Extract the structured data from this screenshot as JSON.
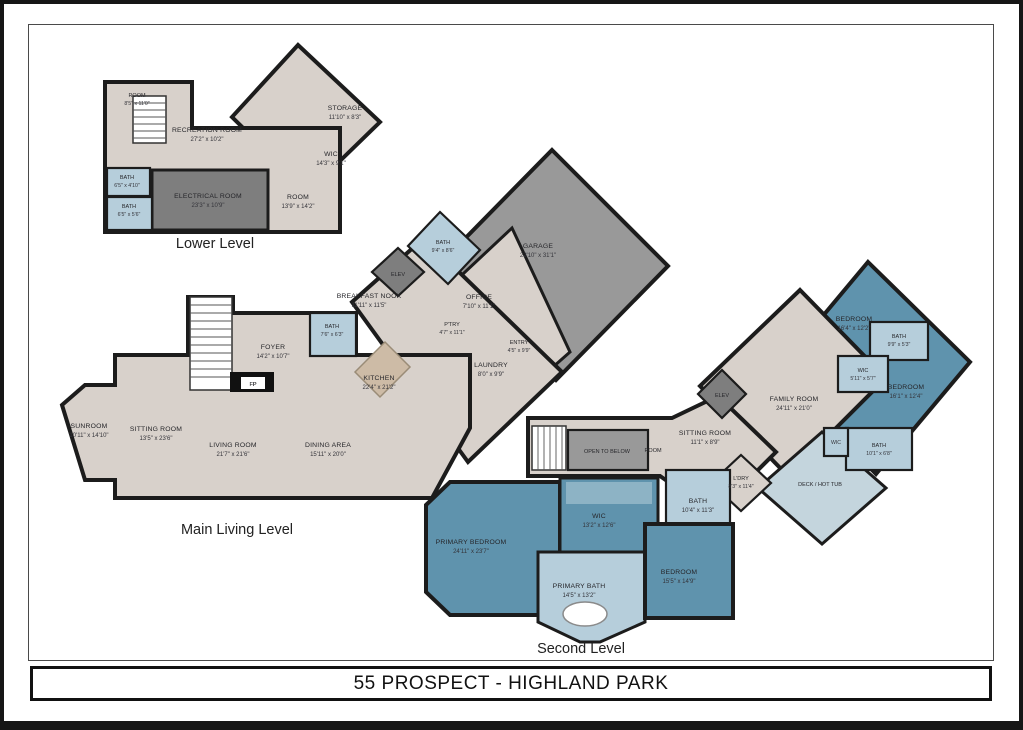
{
  "title": "55 PROSPECT - HIGHLAND PARK",
  "colors": {
    "floor_beige": "#d8d1cb",
    "bedroom_blue": "#5f93ad",
    "bath_blue": "#b6cedb",
    "deck_blue": "#c4d5dd",
    "garage_gray": "#999999",
    "utility_gray": "#7e7e7e",
    "wall": "#1c1c1c"
  },
  "levels": [
    {
      "name": "Lower Level",
      "rooms": [
        {
          "name": "ROOM",
          "dims": "8'5\" x 11'0\""
        },
        {
          "name": "RECREATION ROOM",
          "dims": "27'2\" x 10'2\""
        },
        {
          "name": "STORAGE",
          "dims": "11'10\" x 8'3\""
        },
        {
          "name": "WIC",
          "dims": "14'3\" x 9'1\""
        },
        {
          "name": "BATH",
          "dims": "6'5\" x 4'10\""
        },
        {
          "name": "BATH",
          "dims": "6'5\" x 5'6\""
        },
        {
          "name": "ELECTRICAL ROOM",
          "dims": "23'3\" x 10'9\""
        },
        {
          "name": "ROOM",
          "dims": "13'9\" x 14'2\""
        }
      ]
    },
    {
      "name": "Main Living Level",
      "rooms": [
        {
          "name": "GARAGE",
          "dims": "22'10\" x 31'1\""
        },
        {
          "name": "BATH",
          "dims": "9'4\" x 8'6\""
        },
        {
          "name": "ELEV",
          "dims": ""
        },
        {
          "name": "BREAKFAST NOOK",
          "dims": "11'11\" x 11'5\""
        },
        {
          "name": "OFFICE",
          "dims": "7'10\" x 11'1\""
        },
        {
          "name": "BATH",
          "dims": "7'6\" x 6'3\""
        },
        {
          "name": "FOYER",
          "dims": "14'2\" x 10'7\""
        },
        {
          "name": "P'TRY",
          "dims": "4'7\" x 11'1\""
        },
        {
          "name": "ENTRY",
          "dims": "4'5\" x 9'9\""
        },
        {
          "name": "LAUNDRY",
          "dims": "8'0\" x 9'9\""
        },
        {
          "name": "KITCHEN",
          "dims": "22'4\" x 21'2\""
        },
        {
          "name": "FP",
          "dims": ""
        },
        {
          "name": "SUNROOM",
          "dims": "10'11\" x 14'10\""
        },
        {
          "name": "SITTING ROOM",
          "dims": "13'5\" x 23'6\""
        },
        {
          "name": "LIVING ROOM",
          "dims": "21'7\" x 21'6\""
        },
        {
          "name": "DINING AREA",
          "dims": "15'11\" x 20'0\""
        }
      ]
    },
    {
      "name": "Second Level",
      "rooms": [
        {
          "name": "BEDROOM",
          "dims": "16'4\" x 12'2\""
        },
        {
          "name": "BATH",
          "dims": "9'9\" x 5'3\""
        },
        {
          "name": "WIC",
          "dims": "5'11\" x 5'7\""
        },
        {
          "name": "BEDROOM",
          "dims": "16'1\" x 12'4\""
        },
        {
          "name": "FAMILY ROOM",
          "dims": "24'11\" x 21'0\""
        },
        {
          "name": "ELEV",
          "dims": ""
        },
        {
          "name": "SITTING ROOM",
          "dims": "11'1\" x 8'9\""
        },
        {
          "name": "OPEN TO BELOW",
          "dims": ""
        },
        {
          "name": "ROOM",
          "dims": ""
        },
        {
          "name": "WIC",
          "dims": ""
        },
        {
          "name": "BATH",
          "dims": "10'1\" x 6'8\""
        },
        {
          "name": "L'DRY",
          "dims": "8'3\" x 11'4\""
        },
        {
          "name": "DECK / HOT TUB",
          "dims": ""
        },
        {
          "name": "BATH",
          "dims": "10'4\" x 11'3\""
        },
        {
          "name": "WIC",
          "dims": "13'2\" x 12'6\""
        },
        {
          "name": "PRIMARY BEDROOM",
          "dims": "24'11\" x 23'7\""
        },
        {
          "name": "PRIMARY BATH",
          "dims": "14'5\" x 13'2\""
        },
        {
          "name": "BEDROOM",
          "dims": "15'5\" x 14'9\""
        }
      ]
    }
  ]
}
